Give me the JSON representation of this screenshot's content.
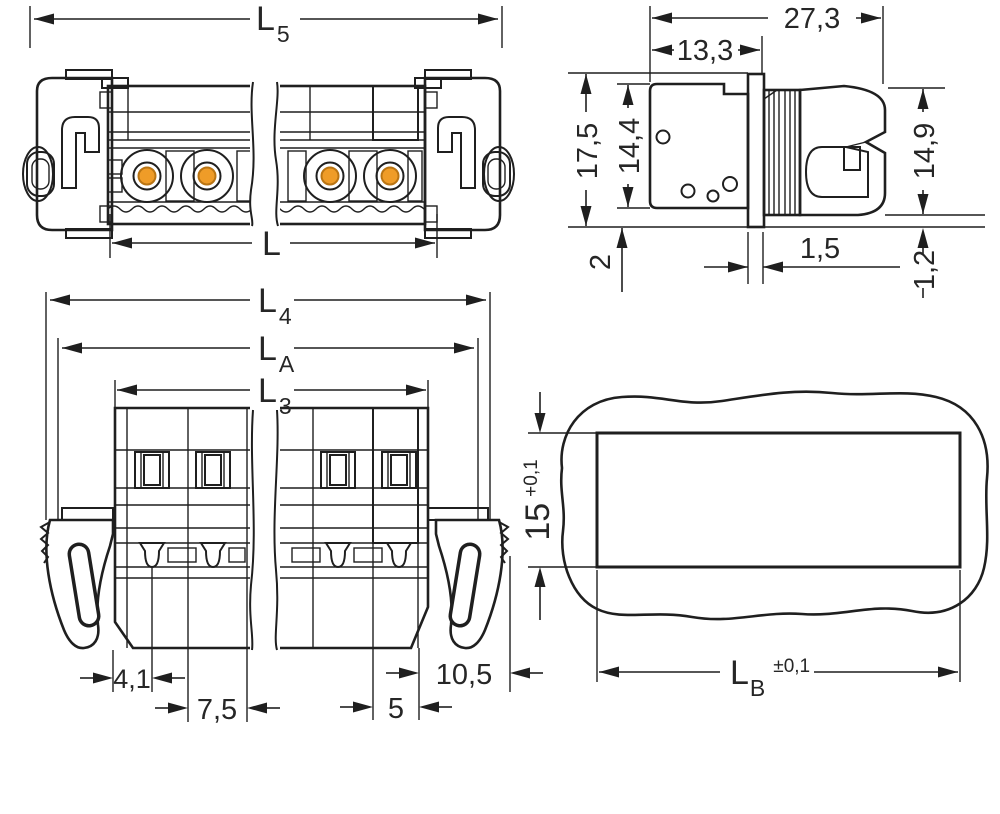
{
  "drawing": {
    "type": "technical-dimension-drawing",
    "colors": {
      "outline": "#1f1f1f",
      "body_gray": "#c6c8ca",
      "body_light": "#d9dbdd",
      "inset_white": "#eef0f0",
      "coding_cyan": "#c3e7ec",
      "coding_teal": "#8eb1b7",
      "contact_yellow": "#f6d71f",
      "contact_orange": "#ef9c28",
      "dim_text": "#262626"
    },
    "views": {
      "side_elevation": {
        "label": "side elevation of male connector",
        "dims": {
          "l5": {
            "main": "L",
            "sub": "5"
          },
          "l": {
            "main": "L"
          }
        }
      },
      "end_profile": {
        "label": "end profile with panel flange",
        "dims": {
          "w_total": "27,3",
          "w_front": "13,3",
          "h_total": "17,5",
          "h_body": "14,4",
          "h_latch": "14,9",
          "flange_below": "2",
          "flange_thickness": "1,5",
          "lip": "1,2"
        }
      },
      "top_view": {
        "label": "top view with locking levers",
        "dims": {
          "l4": {
            "main": "L",
            "sub": "4"
          },
          "la": {
            "main": "L",
            "sub": "A"
          },
          "l3": {
            "main": "L",
            "sub": "3"
          },
          "edge_to_pin": "4,1",
          "pitch": "7,5",
          "pin_to_edge": "5",
          "lever_width": "10,5"
        }
      },
      "panel_cutout": {
        "label": "panel cutout",
        "dims": {
          "height": {
            "main": "15",
            "tol": "+0,1"
          },
          "width": {
            "main": "L",
            "sub": "B",
            "tol": "±0,1"
          }
        }
      }
    }
  }
}
